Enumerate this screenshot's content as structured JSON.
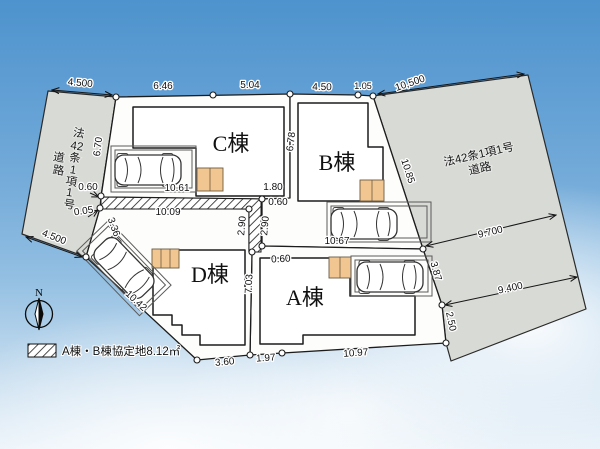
{
  "north": {
    "label": "N"
  },
  "legend": {
    "text": "A棟・B棟協定地8.12㎡"
  },
  "roads": {
    "left_col1": [
      "法",
      "42",
      "条",
      "1",
      "項",
      "1",
      "号"
    ],
    "left_col2": [
      "道",
      "路"
    ],
    "right_line1": "法42条1項1号",
    "right_line2": "道路"
  },
  "buildings": {
    "a": "A棟",
    "b": "B棟",
    "c": "C棟",
    "d": "D棟"
  },
  "dims": {
    "road_left_top": "4.500",
    "c_top_w1": "6.46",
    "c_top_w2": "5.04",
    "b_top_w1": "4.50",
    "b_top_w2": "1.05",
    "road_right_top": "10,500",
    "c_left_h": "6.70",
    "c_right_h": "6.78",
    "b_right": "10.85",
    "c_park_off": "0.60",
    "c_park_w": "10.61",
    "c_bottom_e": "1.80",
    "road_gap": "0.05",
    "strip_w": "10.09",
    "strip_e_off": "0.60",
    "d_nw_edge": "3.36",
    "strip_v_l": "2.90",
    "strip_v_r": "2.90",
    "b_bottom_w": "10.67",
    "a_nw_off": "0.60",
    "road_right_w1": "9.700",
    "a_right_e1": "3.87",
    "road_right_w2": "9.400",
    "a_right_e2": "2.50",
    "d_sw_edge": "10.42",
    "d_right_h": "7.03",
    "d_bottom_w": "3.60",
    "a_bottom_w1": "1.97",
    "a_bottom_w2": "10.97",
    "road_left_bottom": "4.500"
  }
}
